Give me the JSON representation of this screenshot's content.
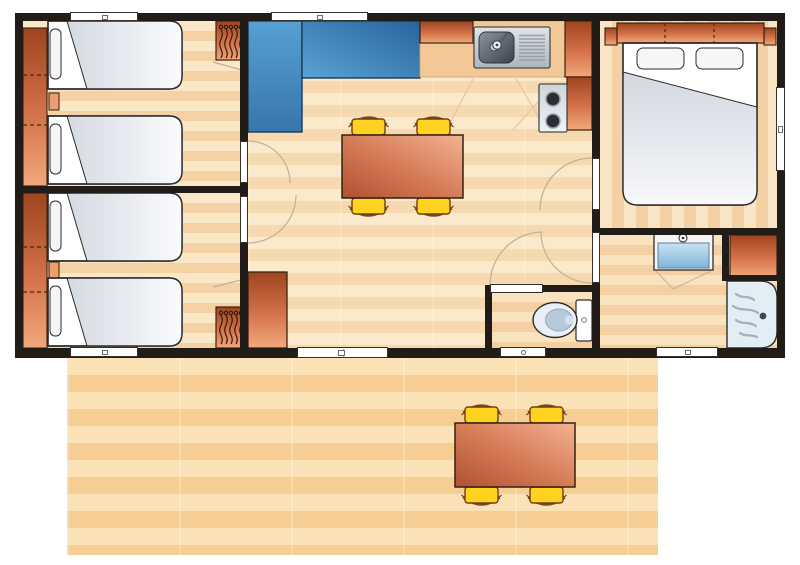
{
  "page": {
    "type": "floor-plan-diagram",
    "visible_text": [],
    "rooms": [
      {
        "name": "twin-bedroom-top",
        "furniture": [
          "wardrobe-strip",
          "single-bed",
          "single-bed",
          "nightstand",
          "hanging-closet",
          "window"
        ]
      },
      {
        "name": "twin-bedroom-bottom",
        "furniture": [
          "wardrobe-strip",
          "single-bed",
          "single-bed",
          "nightstand",
          "hanging-closet",
          "window"
        ]
      },
      {
        "name": "living-dining",
        "furniture": [
          "corner-sofa",
          "dining-table",
          "chair",
          "chair",
          "chair",
          "chair",
          "tall-cabinet",
          "window",
          "sliding-door"
        ]
      },
      {
        "name": "kitchen",
        "furniture": [
          "worktop",
          "sink-with-drainer",
          "hob-2-burners",
          "cabinet",
          "cabinet",
          "cabinet"
        ]
      },
      {
        "name": "master-bedroom",
        "furniture": [
          "double-bed",
          "headboard-wardrobe",
          "window"
        ]
      },
      {
        "name": "bathroom",
        "furniture": [
          "washbasin",
          "cabinet",
          "shower",
          "window"
        ]
      },
      {
        "name": "wc",
        "furniture": [
          "toilet",
          "window",
          "door"
        ]
      },
      {
        "name": "terrace",
        "furniture": [
          "outdoor-table",
          "chair",
          "chair",
          "chair",
          "chair"
        ]
      }
    ]
  },
  "palette": {
    "wall": "#211C18",
    "floorLight": "#FAE7C6",
    "floorDark": "#F5D2A6",
    "livingLight": "#FBE9CB",
    "livingDark": "#F7D9AF",
    "masterLight": "#F9E4C3",
    "masterDark": "#F3D1A4",
    "bathLight": "#F9E2BE",
    "bathDark": "#F4CFA1",
    "terraceLight": "#FAE2B6",
    "terraceDark": "#F6CE94",
    "furnitureOrangeDark": "#9E441F",
    "furnitureOrangeMid": "#D4724A",
    "furnitureOrangeLight": "#F2A87C",
    "sofaLight": "#5AA3D6",
    "sofaDark": "#27649C",
    "chairYellow": "#FFD21F",
    "chairBrown": "#7A4A1E",
    "tableDark": "#AF5132",
    "tableLight": "#F4B294",
    "bedWhite": "#FFFFFF",
    "duvetGray": "#D5DAE2",
    "steelLight": "#E0E4E7",
    "steelDark": "#39414B",
    "waterBlue": "#7FB6DC",
    "showerFill": "#E3EDF4",
    "windowWhite": "#FFFFFF",
    "doorArc": "#C1B299"
  }
}
